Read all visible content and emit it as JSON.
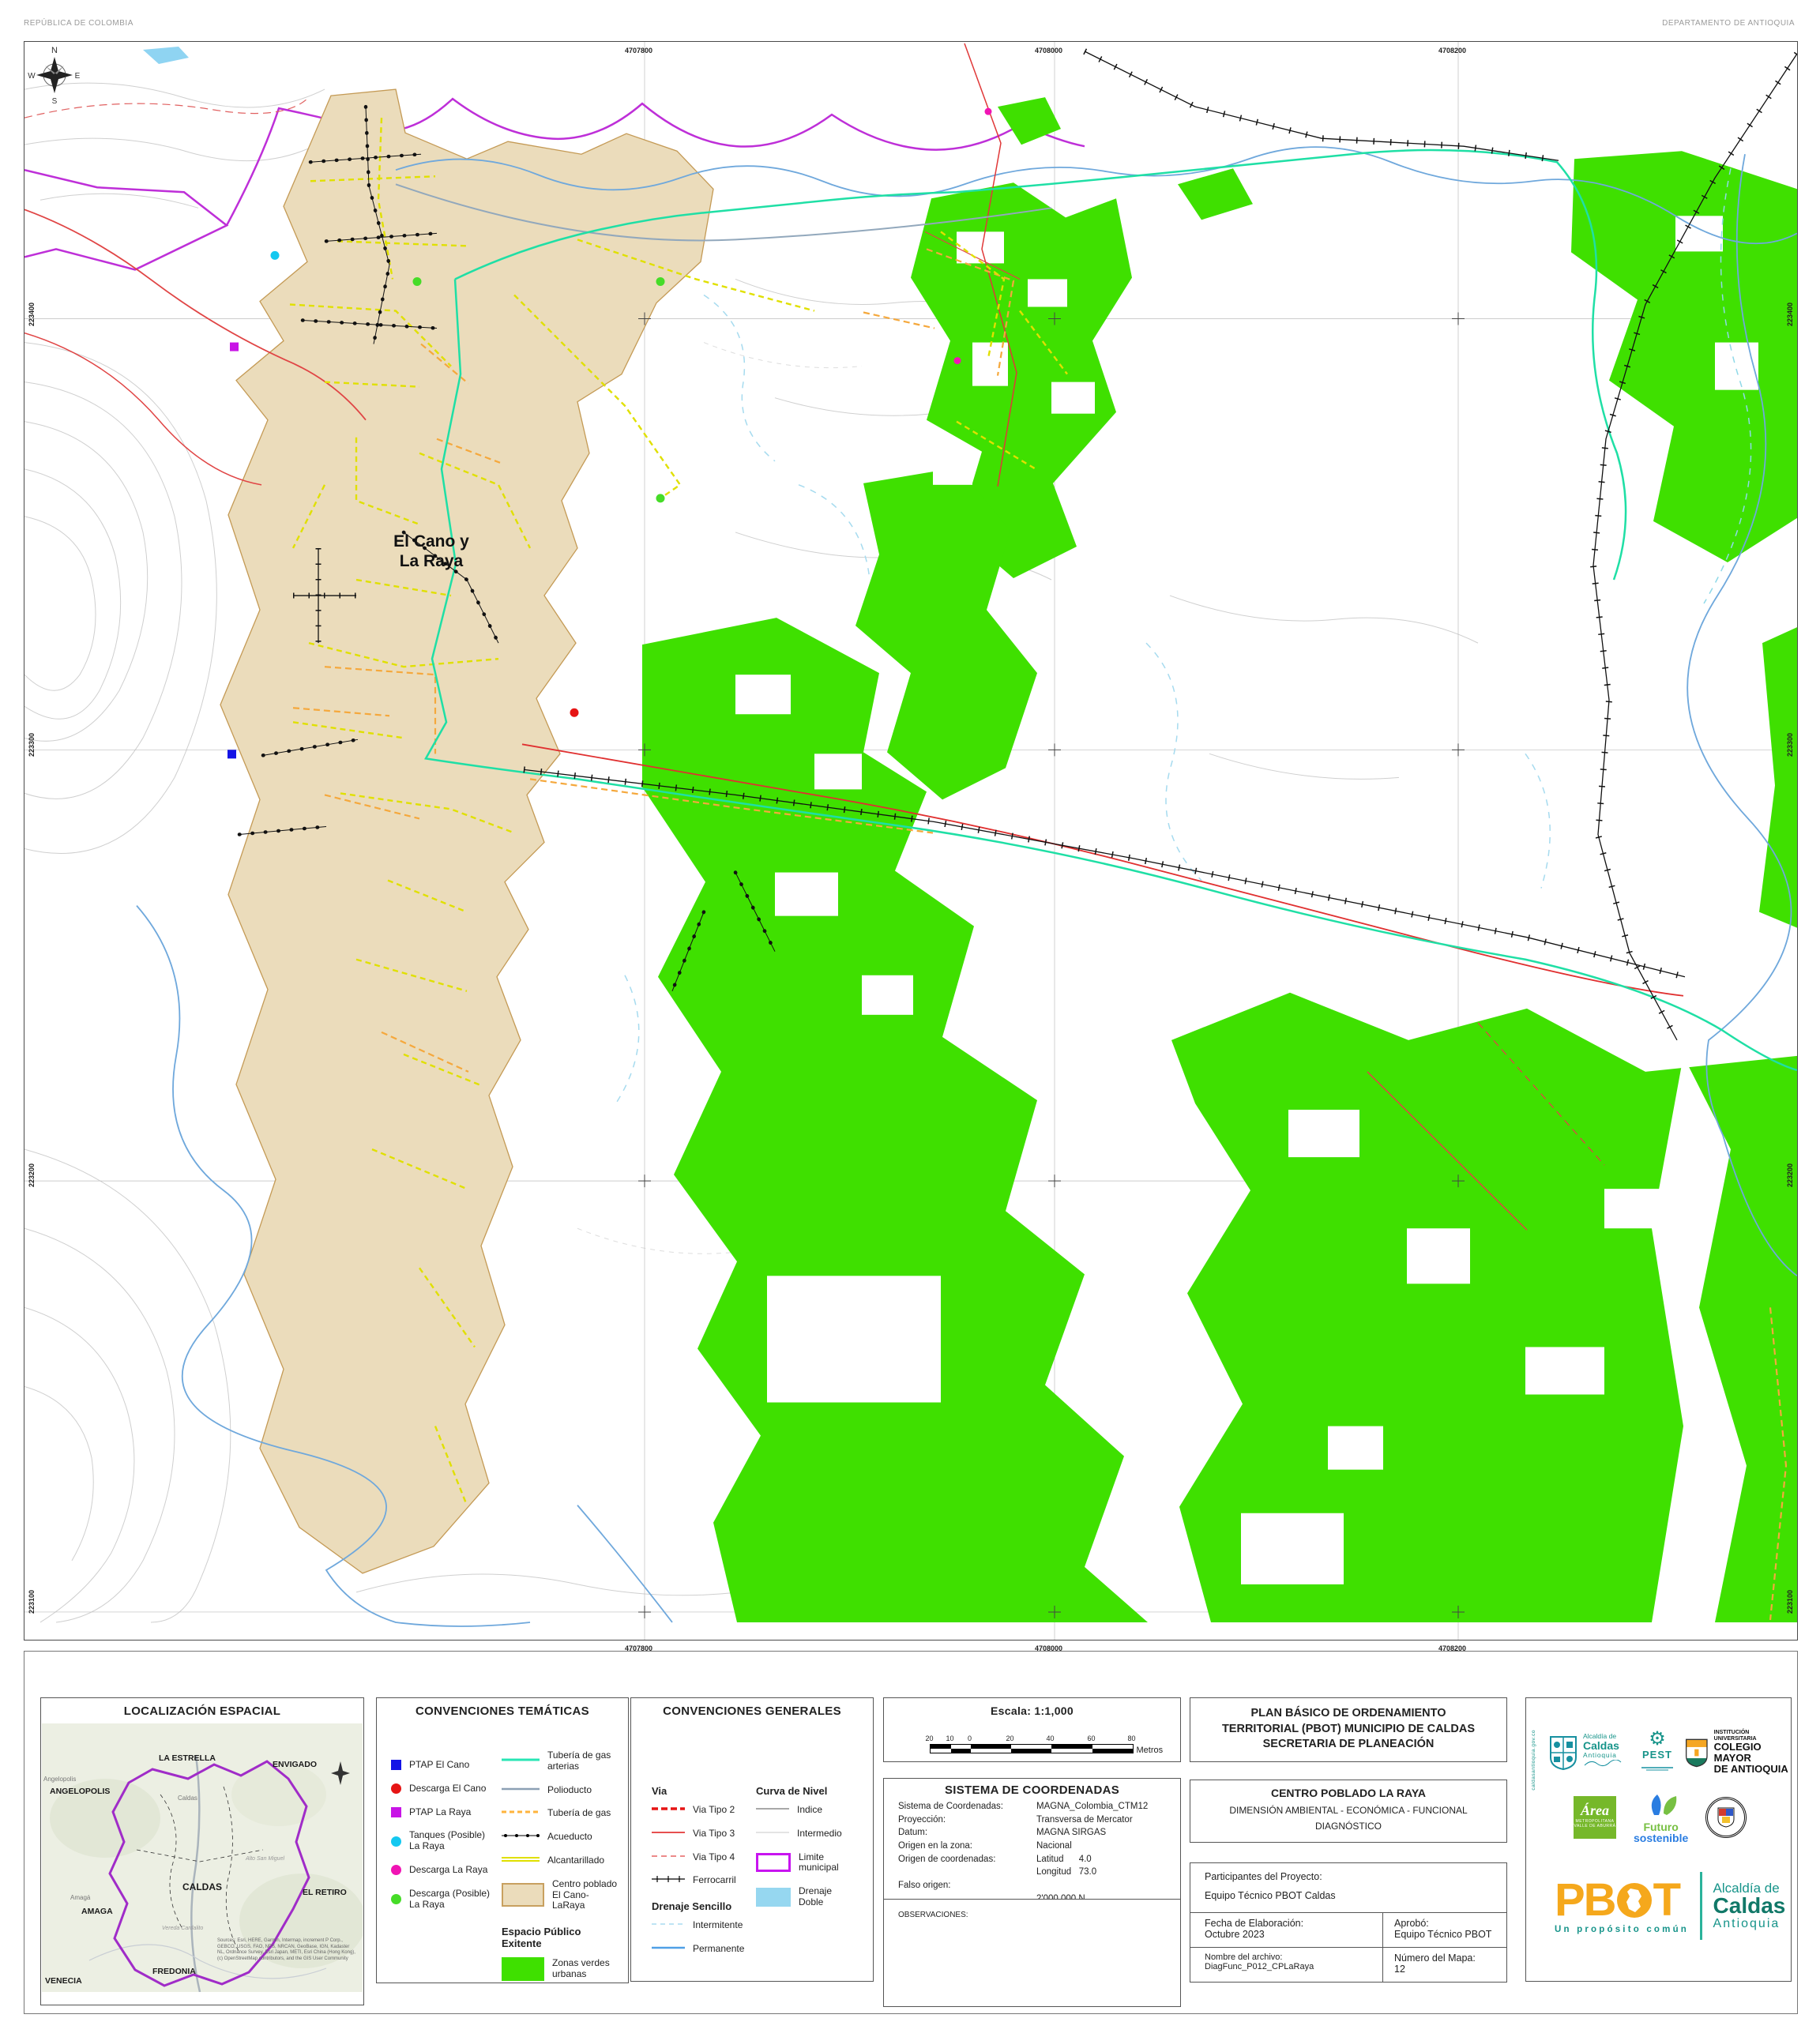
{
  "header": {
    "left": "REPÚBLICA DE COLOMBIA",
    "right": "DEPARTAMENTO DE ANTIOQUIA"
  },
  "map": {
    "place_line1": "El Cano y",
    "place_line2": "La Raya",
    "compass": {
      "n": "N",
      "e": "E",
      "s": "S",
      "w": "W"
    },
    "grid": {
      "top": [
        "4707800",
        "4708000",
        "4708200"
      ],
      "bottom": [
        "4707800",
        "4708000",
        "4708200"
      ],
      "left": [
        "223400",
        "223300",
        "223200",
        "223100"
      ],
      "right": [
        "223400",
        "223300",
        "223200",
        "223100"
      ]
    }
  },
  "localizacion": {
    "title": "LOCALIZACIÓN ESPACIAL",
    "labels": {
      "angelopolis": "ANGELOPOLIS",
      "angelopolis_small": "Angelopolis",
      "la_estrella": "LA ESTRELLA",
      "envigado": "ENVIGADO",
      "caldas_small": "Caldas",
      "caldas": "CALDAS",
      "el_retiro": "EL RETIRO",
      "amaga": "AMAGA",
      "amaga_small": "Amagá",
      "alto": "Alto San Miguel",
      "vereda": "Vereda Cardalito",
      "fredonia": "FREDONIA",
      "venecia": "VENECIA",
      "n": "N"
    },
    "sources": "Sources: Esri, HERE, Garmin, Intermap, increment P Corp., GEBCO, USGS, FAO, NPS, NRCAN, GeoBase, IGN, Kadaster NL, Ordnance Survey, Esri Japan, METI, Esri China (Hong Kong), (c) OpenStreetMap contributors, and the GIS User Community"
  },
  "tematicas": {
    "title": "CONVENCIONES TEMÁTICAS",
    "points": [
      {
        "label": "PTAP El Cano",
        "color": "#1414E6"
      },
      {
        "label": "Descarga El Cano",
        "color": "#E61414"
      },
      {
        "label": "PTAP La Raya",
        "color": "#C814E6"
      },
      {
        "label": "Tanques (Posible) La Raya",
        "color": "#14C8F0"
      },
      {
        "label": "Descarga La Raya",
        "color": "#F014B4"
      },
      {
        "label": "Descarga (Posible) La Raya",
        "color": "#46DC28"
      }
    ],
    "lines": [
      {
        "label": "Tubería de gas arterias",
        "color": "#28E6B4"
      },
      {
        "label": "Polioducto",
        "color": "#8CA0B4"
      },
      {
        "label": "Tubería de gas",
        "color": "#FFB43C"
      },
      {
        "label": "Acueducto",
        "color": "#000000"
      },
      {
        "label": "Alcantarillado",
        "color": "#E0E000"
      }
    ],
    "centro_poblado": {
      "label": "Centro poblado El Cano-LaRaya",
      "fill": "#EBDCBB",
      "stroke": "#C8A05F"
    },
    "espacio_titulo": "Espacio Público Exitente",
    "zonas": {
      "label": "Zonas verdes urbanas",
      "fill": "#3FE000"
    }
  },
  "generales": {
    "title": "CONVENCIONES GENERALES",
    "via_titulo": "Via",
    "curva_titulo": "Curva de Nivel",
    "vias": [
      {
        "label": "Via  Tipo 2",
        "color": "#E61414"
      },
      {
        "label": "Via  Tipo 3",
        "color": "#E65050"
      },
      {
        "label": "Via  Tipo 4",
        "color": "#E66464"
      },
      {
        "label": "Ferrocarril",
        "color": "#000000"
      }
    ],
    "curvas": [
      {
        "label": "Indice",
        "color": "#8C8C8C"
      },
      {
        "label": "Intermedio",
        "color": "#C8C8C8"
      },
      {
        "label": "Limite municipal",
        "color": "#C814F0"
      },
      {
        "label": "Drenaje Doble",
        "color": "#96D7F0"
      }
    ],
    "drenaje_titulo": "Drenaje Sencillo",
    "drenajes": [
      {
        "label": "Intermitente",
        "color": "#A8DCF0"
      },
      {
        "label": "Permanente",
        "color": "#50A0E6"
      }
    ]
  },
  "escala": {
    "titulo": "Escala: 1:1,000",
    "ticks": [
      "20",
      "10",
      "0",
      "20",
      "40",
      "60",
      "80"
    ],
    "unidad": "Metros"
  },
  "coordenadas": {
    "titulo": "SISTEMA DE COORDENADAS",
    "rows": [
      {
        "l": "Sistema de Coordenadas:",
        "v": "MAGNA_Colombia_CTM12"
      },
      {
        "l": "Proyección:",
        "v": "Transversa de Mercator"
      },
      {
        "l": "Datum:",
        "v": "MAGNA SIRGAS"
      },
      {
        "l": "Origen en la zona:",
        "v": "Nacional"
      },
      {
        "l": "Origen de coordenadas:",
        "v": "Latitud      4.0"
      },
      {
        "l": "",
        "v": "Longitud   73.0"
      },
      {
        "l": "Falso origen:",
        "v": ""
      },
      {
        "l": "",
        "v": "2'000.000 N"
      },
      {
        "l": "",
        "v": "5'000.000 E"
      }
    ]
  },
  "observaciones": "OBSERVACIONES:",
  "titulo": {
    "l1": "PLAN BÁSICO DE ORDENAMIENTO",
    "l2": "TERRITORIAL (PBOT) MUNICIPIO DE CALDAS",
    "l3": "SECRETARIA DE PLANEACIÓN",
    "centro": "CENTRO POBLADO LA RAYA",
    "dim": "DIMENSIÓN AMBIENTAL - ECONÓMICA - FUNCIONAL",
    "diag": "DIAGNÓSTICO",
    "part_label": "Participantes del Proyecto:",
    "part": "Equipo Técnico PBOT Caldas",
    "fecha_label": "Fecha de Elaboración:",
    "fecha": "Octubre 2023",
    "aprobo_label": "Aprobó:",
    "aprobo": "Equipo Técnico PBOT",
    "arch_label": "Nombre del archivo:",
    "arch": "DiagFunc_P012_CPLaRaya",
    "num_label": "Número del Mapa:",
    "num": "12"
  },
  "logos": {
    "vertical": "caldasantioquia.gov.co",
    "alc_s1": "Alcaldía de",
    "alc_s2": "Caldas",
    "alc_s3": "Antioquia",
    "pest": "PEST",
    "col1": "INSTITUCIÓN UNIVERSITARIA",
    "col2": "COLEGIO MAYOR",
    "col3": "DE ANTIOQUIA",
    "area1": "Área",
    "area2": "METROPOLITANA",
    "area3": "VALLE DE ABURRÁ",
    "fut1": "Futuro",
    "fut2": "sostenible",
    "pbot": "PB",
    "pbot_t": "T",
    "pbot_tagline": "Un propósito común",
    "alc_r1": "Alcaldía de",
    "alc_r2": "Caldas",
    "alc_r3": "Antioquia"
  }
}
